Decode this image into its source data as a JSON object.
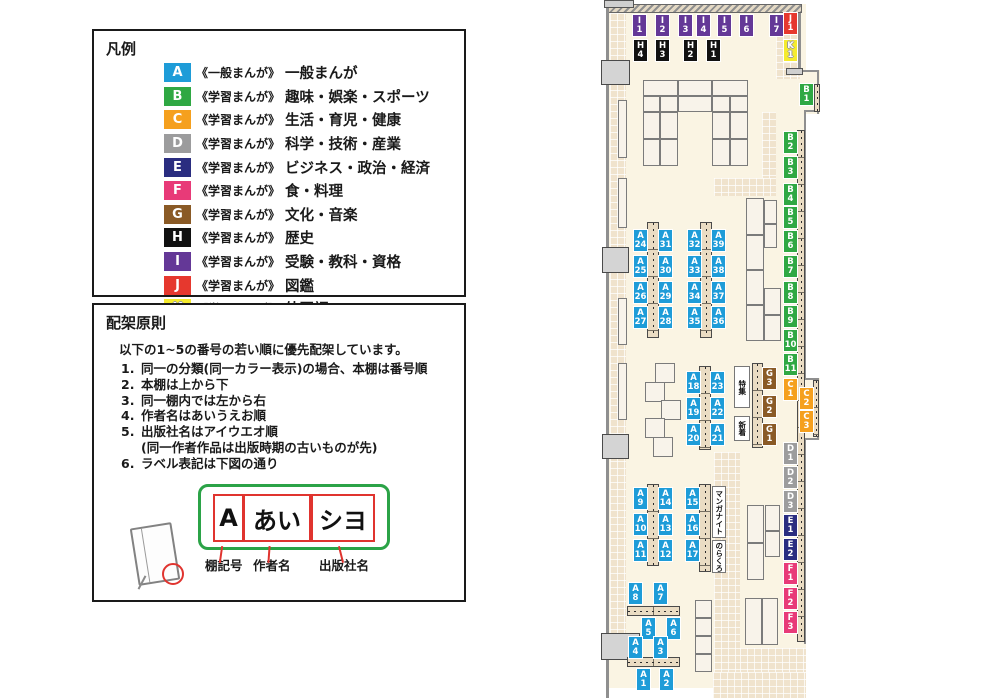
{
  "legend": {
    "title": "凡例",
    "items": [
      {
        "code": "A",
        "color": "#1E9CD8",
        "series": "《一般まんが》",
        "label": "一般まんが"
      },
      {
        "code": "B",
        "color": "#2FA843",
        "series": "《学習まんが》",
        "label": "趣味・娯楽・スポーツ"
      },
      {
        "code": "C",
        "color": "#F5A01E",
        "series": "《学習まんが》",
        "label": "生活・育児・健康"
      },
      {
        "code": "D",
        "color": "#9C9C9D",
        "series": "《学習まんが》",
        "label": "科学・技術・産業"
      },
      {
        "code": "E",
        "color": "#2A2D80",
        "series": "《学習まんが》",
        "label": "ビジネス・政治・経済"
      },
      {
        "code": "F",
        "color": "#E83A78",
        "series": "《学習まんが》",
        "label": "食・料理"
      },
      {
        "code": "G",
        "color": "#8A5A26",
        "series": "《学習まんが》",
        "label": "文化・音楽"
      },
      {
        "code": "H",
        "color": "#111111",
        "series": "《学習まんが》",
        "label": "歴史"
      },
      {
        "code": "I",
        "color": "#643897",
        "series": "《学習まんが》",
        "label": "受験・教科・資格"
      },
      {
        "code": "J",
        "color": "#E6382E",
        "series": "《学習まんが》",
        "label": "図鑑"
      },
      {
        "code": "K",
        "color": "#F5EB2E",
        "series": "《学習まんが》",
        "label": "外国語"
      }
    ]
  },
  "principles": {
    "title": "配架原則",
    "intro": "以下の1~5の番号の若い順に優先配架しています。",
    "rules": [
      {
        "num": "1.",
        "text": "同一の分類(同一カラー表示)の場合、本棚は番号順"
      },
      {
        "num": "2.",
        "text": "本棚は上から下"
      },
      {
        "num": "3.",
        "text": "同一棚内では左から右"
      },
      {
        "num": "4.",
        "text": "作者名はあいうえお順"
      },
      {
        "num": "5.",
        "text": "出版社名はアイウエオ順"
      },
      {
        "num": "",
        "text": "(同一作者作品は出版時期の古いものが先)",
        "note": true
      },
      {
        "num": "6.",
        "text": "ラベル表記は下図の通り"
      }
    ],
    "label_diagram": {
      "parts": [
        {
          "text": "A",
          "caption": "棚記号",
          "x": 12,
          "w": 27,
          "cap_x": 111,
          "conn_x": 126,
          "conn_rot": 8
        },
        {
          "text": "あい",
          "caption": "作者名",
          "x": 42,
          "w": 64,
          "cap_x": 159,
          "conn_x": 174,
          "conn_rot": 4
        },
        {
          "text": "シヨ",
          "caption": "出版社名",
          "x": 110,
          "w": 60,
          "cap_x": 225,
          "conn_x": 246,
          "conn_rot": -14
        }
      ]
    }
  },
  "map": {
    "areas": [
      {
        "text": "特集",
        "x": 734,
        "y": 366,
        "w": 16,
        "h": 42
      },
      {
        "text": "新着",
        "x": 734,
        "y": 416,
        "w": 16,
        "h": 25
      },
      {
        "text": "マンガナイト",
        "x": 712,
        "y": 486,
        "w": 14,
        "h": 52
      },
      {
        "text": "のらくろ",
        "x": 712,
        "y": 540,
        "w": 14,
        "h": 33
      }
    ],
    "floor": [
      [
        606,
        4,
        200,
        684
      ],
      [
        806,
        70,
        14,
        44
      ],
      [
        806,
        378,
        14,
        62
      ]
    ],
    "tiles": [
      [
        610,
        13,
        16,
        647
      ],
      [
        776,
        13,
        24,
        66
      ],
      [
        762,
        112,
        14,
        68
      ],
      [
        714,
        178,
        62,
        18
      ],
      [
        714,
        452,
        26,
        220
      ],
      [
        740,
        648,
        66,
        26
      ],
      [
        713,
        672,
        93,
        26
      ]
    ],
    "hatch_walls": [
      [
        608,
        4,
        194,
        9
      ]
    ],
    "gray_blocks": [
      [
        604,
        0,
        30,
        8
      ],
      [
        786,
        68,
        17,
        7
      ]
    ],
    "wall_lines": [
      [
        606,
        8,
        3,
        690
      ],
      [
        798,
        13,
        3,
        57
      ],
      [
        804,
        112,
        2,
        266
      ],
      [
        804,
        440,
        2,
        204
      ],
      [
        817,
        70,
        2,
        44
      ],
      [
        817,
        378,
        2,
        62
      ],
      [
        800,
        70,
        19,
        2
      ],
      [
        804,
        110,
        15,
        2
      ],
      [
        804,
        378,
        15,
        2
      ],
      [
        804,
        438,
        15,
        2
      ]
    ],
    "doors": [
      [
        601,
        60,
        29,
        25
      ],
      [
        602,
        247,
        27,
        26
      ],
      [
        602,
        434,
        27,
        25
      ],
      [
        601,
        633,
        39,
        27
      ]
    ],
    "shelves": [
      [
        643,
        80,
        35,
        16
      ],
      [
        678,
        80,
        34,
        16
      ],
      [
        712,
        80,
        36,
        16
      ],
      [
        643,
        96,
        17,
        16
      ],
      [
        660,
        96,
        18,
        16
      ],
      [
        678,
        96,
        34,
        16
      ],
      [
        712,
        96,
        18,
        16
      ],
      [
        730,
        96,
        18,
        16
      ],
      [
        643,
        112,
        17,
        27
      ],
      [
        660,
        112,
        18,
        27
      ],
      [
        712,
        112,
        18,
        27
      ],
      [
        730,
        112,
        18,
        27
      ],
      [
        643,
        139,
        17,
        27
      ],
      [
        660,
        139,
        18,
        27
      ],
      [
        712,
        139,
        18,
        27
      ],
      [
        730,
        139,
        18,
        27
      ],
      [
        618,
        100,
        9,
        58
      ],
      [
        618,
        178,
        9,
        50
      ],
      [
        618,
        298,
        9,
        47
      ],
      [
        618,
        363,
        9,
        57
      ],
      [
        746,
        198,
        18,
        37
      ],
      [
        746,
        235,
        18,
        35
      ],
      [
        746,
        270,
        18,
        35
      ],
      [
        746,
        305,
        18,
        36
      ],
      [
        764,
        200,
        13,
        24
      ],
      [
        764,
        224,
        13,
        24
      ],
      [
        764,
        288,
        17,
        27
      ],
      [
        764,
        315,
        17,
        26
      ],
      [
        655,
        363,
        20,
        20
      ],
      [
        645,
        382,
        20,
        20
      ],
      [
        661,
        400,
        20,
        20
      ],
      [
        645,
        418,
        20,
        20
      ],
      [
        653,
        437,
        20,
        20
      ],
      [
        747,
        505,
        17,
        38
      ],
      [
        747,
        543,
        17,
        37
      ],
      [
        765,
        505,
        15,
        26
      ],
      [
        765,
        531,
        15,
        26
      ],
      [
        745,
        598,
        17,
        47
      ],
      [
        762,
        598,
        16,
        47
      ],
      [
        695,
        600,
        17,
        18
      ],
      [
        695,
        618,
        17,
        18
      ],
      [
        695,
        636,
        17,
        18
      ],
      [
        695,
        654,
        17,
        18
      ]
    ],
    "strips_v": [
      [
        647,
        222,
        12,
        116
      ],
      [
        700,
        222,
        12,
        116
      ],
      [
        699,
        366,
        12,
        84
      ],
      [
        752,
        363,
        11,
        85
      ],
      [
        647,
        484,
        12,
        82
      ],
      [
        699,
        484,
        12,
        88
      ],
      [
        797,
        130,
        8,
        512
      ],
      [
        814,
        84,
        6,
        28
      ],
      [
        813,
        380,
        6,
        57
      ]
    ],
    "strips_h": [
      [
        627,
        606,
        53,
        10
      ],
      [
        627,
        657,
        53,
        10
      ]
    ],
    "labels": [
      [
        "I1",
        633,
        15
      ],
      [
        "I2",
        656,
        15
      ],
      [
        "I3",
        679,
        15
      ],
      [
        "I4",
        697,
        15
      ],
      [
        "I5",
        718,
        15
      ],
      [
        "I6",
        740,
        15
      ],
      [
        "I7",
        770,
        15
      ],
      [
        "J1",
        784,
        13
      ],
      [
        "H4",
        634,
        40
      ],
      [
        "H3",
        656,
        40
      ],
      [
        "H2",
        684,
        40
      ],
      [
        "H1",
        707,
        40
      ],
      [
        "K1",
        784,
        40
      ],
      [
        "B1",
        800,
        84
      ],
      [
        "B2",
        784,
        132
      ],
      [
        "B3",
        784,
        157
      ],
      [
        "B4",
        784,
        184
      ],
      [
        "B5",
        784,
        207
      ],
      [
        "B6",
        784,
        231
      ],
      [
        "B7",
        784,
        256
      ],
      [
        "B8",
        784,
        282
      ],
      [
        "B9",
        784,
        306
      ],
      [
        "B10",
        784,
        330
      ],
      [
        "B11",
        784,
        354
      ],
      [
        "C1",
        784,
        379
      ],
      [
        "C2",
        800,
        388
      ],
      [
        "C3",
        800,
        411
      ],
      [
        "G3",
        763,
        368
      ],
      [
        "G2",
        763,
        396
      ],
      [
        "G1",
        763,
        424
      ],
      [
        "D1",
        784,
        443
      ],
      [
        "D2",
        784,
        467
      ],
      [
        "D3",
        784,
        491
      ],
      [
        "E1",
        784,
        515
      ],
      [
        "E2",
        784,
        539
      ],
      [
        "F1",
        784,
        563
      ],
      [
        "F2",
        784,
        588
      ],
      [
        "F3",
        784,
        612
      ],
      [
        "A24",
        634,
        230
      ],
      [
        "A31",
        659,
        230
      ],
      [
        "A25",
        634,
        256
      ],
      [
        "A30",
        659,
        256
      ],
      [
        "A26",
        634,
        282
      ],
      [
        "A29",
        659,
        282
      ],
      [
        "A27",
        634,
        307
      ],
      [
        "A28",
        659,
        307
      ],
      [
        "A32",
        688,
        230
      ],
      [
        "A39",
        712,
        230
      ],
      [
        "A33",
        688,
        256
      ],
      [
        "A38",
        712,
        256
      ],
      [
        "A34",
        688,
        282
      ],
      [
        "A37",
        712,
        282
      ],
      [
        "A35",
        688,
        307
      ],
      [
        "A36",
        712,
        307
      ],
      [
        "A18",
        687,
        372
      ],
      [
        "A23",
        711,
        372
      ],
      [
        "A19",
        687,
        398
      ],
      [
        "A22",
        711,
        398
      ],
      [
        "A20",
        687,
        424
      ],
      [
        "A21",
        711,
        424
      ],
      [
        "A9",
        634,
        488
      ],
      [
        "A14",
        659,
        488
      ],
      [
        "A10",
        634,
        514
      ],
      [
        "A13",
        659,
        514
      ],
      [
        "A11",
        634,
        540
      ],
      [
        "A12",
        659,
        540
      ],
      [
        "A15",
        686,
        488
      ],
      [
        "A16",
        686,
        514
      ],
      [
        "A17",
        686,
        540
      ],
      [
        "A8",
        629,
        583
      ],
      [
        "A7",
        654,
        583
      ],
      [
        "A5",
        642,
        618
      ],
      [
        "A6",
        667,
        618
      ],
      [
        "A4",
        629,
        637
      ],
      [
        "A3",
        654,
        637
      ],
      [
        "A1",
        637,
        669
      ],
      [
        "A2",
        660,
        669
      ]
    ]
  },
  "colors": {
    "A": "#1E9CD8",
    "B": "#2FA843",
    "C": "#F5A01E",
    "D": "#9C9C9D",
    "E": "#2A2D80",
    "F": "#E83A78",
    "G": "#8A5A26",
    "H": "#111111",
    "I": "#643897",
    "J": "#E6382E",
    "K": "#F5EB2E"
  },
  "palette": {
    "floor": "#FAF4E3",
    "tile": "#F0E3CD",
    "strip": "#EADCC3",
    "shelf": "#F8F3EA",
    "wall": "#8F8F8F"
  }
}
